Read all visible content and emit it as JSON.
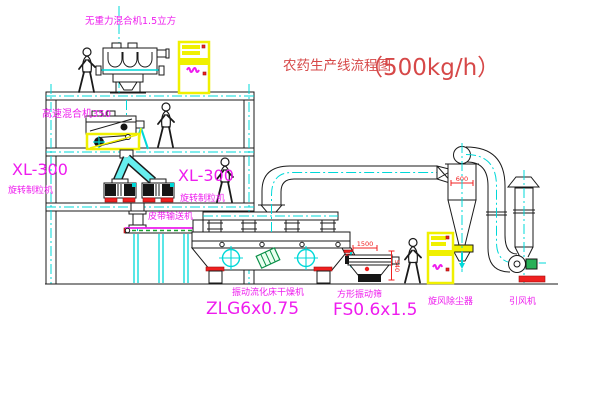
{
  "title": {
    "name": "农药生产线流程图",
    "capacity": "（500kg/h）"
  },
  "equipment": {
    "gravity_mixer": {
      "label": "无重力混合机1.5立方"
    },
    "high_speed_mixer": {
      "label": "高速混合机350"
    },
    "granulator_left": {
      "model": "XL-300",
      "label": "旋转制粒机"
    },
    "granulator_right": {
      "model": "XL-300",
      "label": "旋转制粒机"
    },
    "belt_conveyor": {
      "label": "皮带输送机"
    },
    "fluid_bed_dryer": {
      "label": "振动流化床干燥机",
      "model": "ZLG6x0.75"
    },
    "vibrating_sieve": {
      "label": "方形振动筛",
      "model": "FS0.6x1.5",
      "dim_length": "1500",
      "dim_height": "540"
    },
    "cyclone": {
      "label": "旋风除尘器",
      "dim_width": "600"
    },
    "fan": {
      "label": "引风机"
    }
  },
  "colors": {
    "label_magenta": "#ee1cee",
    "title_red": "#d64848",
    "dimension_red": "#f02020",
    "centerline_cyan": "#00d8d8",
    "cabinet_yellow": "#f0f000",
    "motor_green": "#28b058",
    "base_red": "#f02020",
    "line_black": "#1a1a1a"
  }
}
